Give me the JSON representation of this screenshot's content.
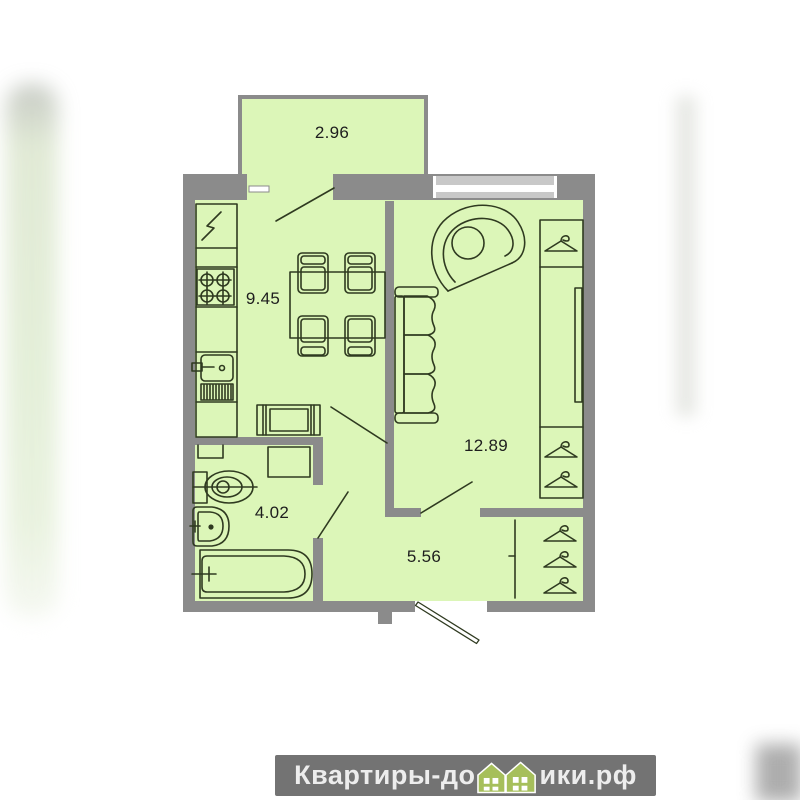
{
  "plan": {
    "rooms": [
      {
        "name": "balcony",
        "area": "2.96"
      },
      {
        "name": "kitchen",
        "area": "9.45"
      },
      {
        "name": "living-room",
        "area": "12.89"
      },
      {
        "name": "bathroom",
        "area": "4.02"
      },
      {
        "name": "hallway",
        "area": "5.56"
      }
    ],
    "colors": {
      "floor_fill": "#dcf6b8",
      "wall": "#8b8b8b",
      "furniture_outline": "#2f3a20",
      "window_frame": "#c8c8c8"
    }
  },
  "watermark": {
    "prefix": "Квартиры-до",
    "suffix": "ики.рф",
    "bar_color": "#737373",
    "text_color": "#ededed",
    "house_color": "#a6bf5b"
  }
}
